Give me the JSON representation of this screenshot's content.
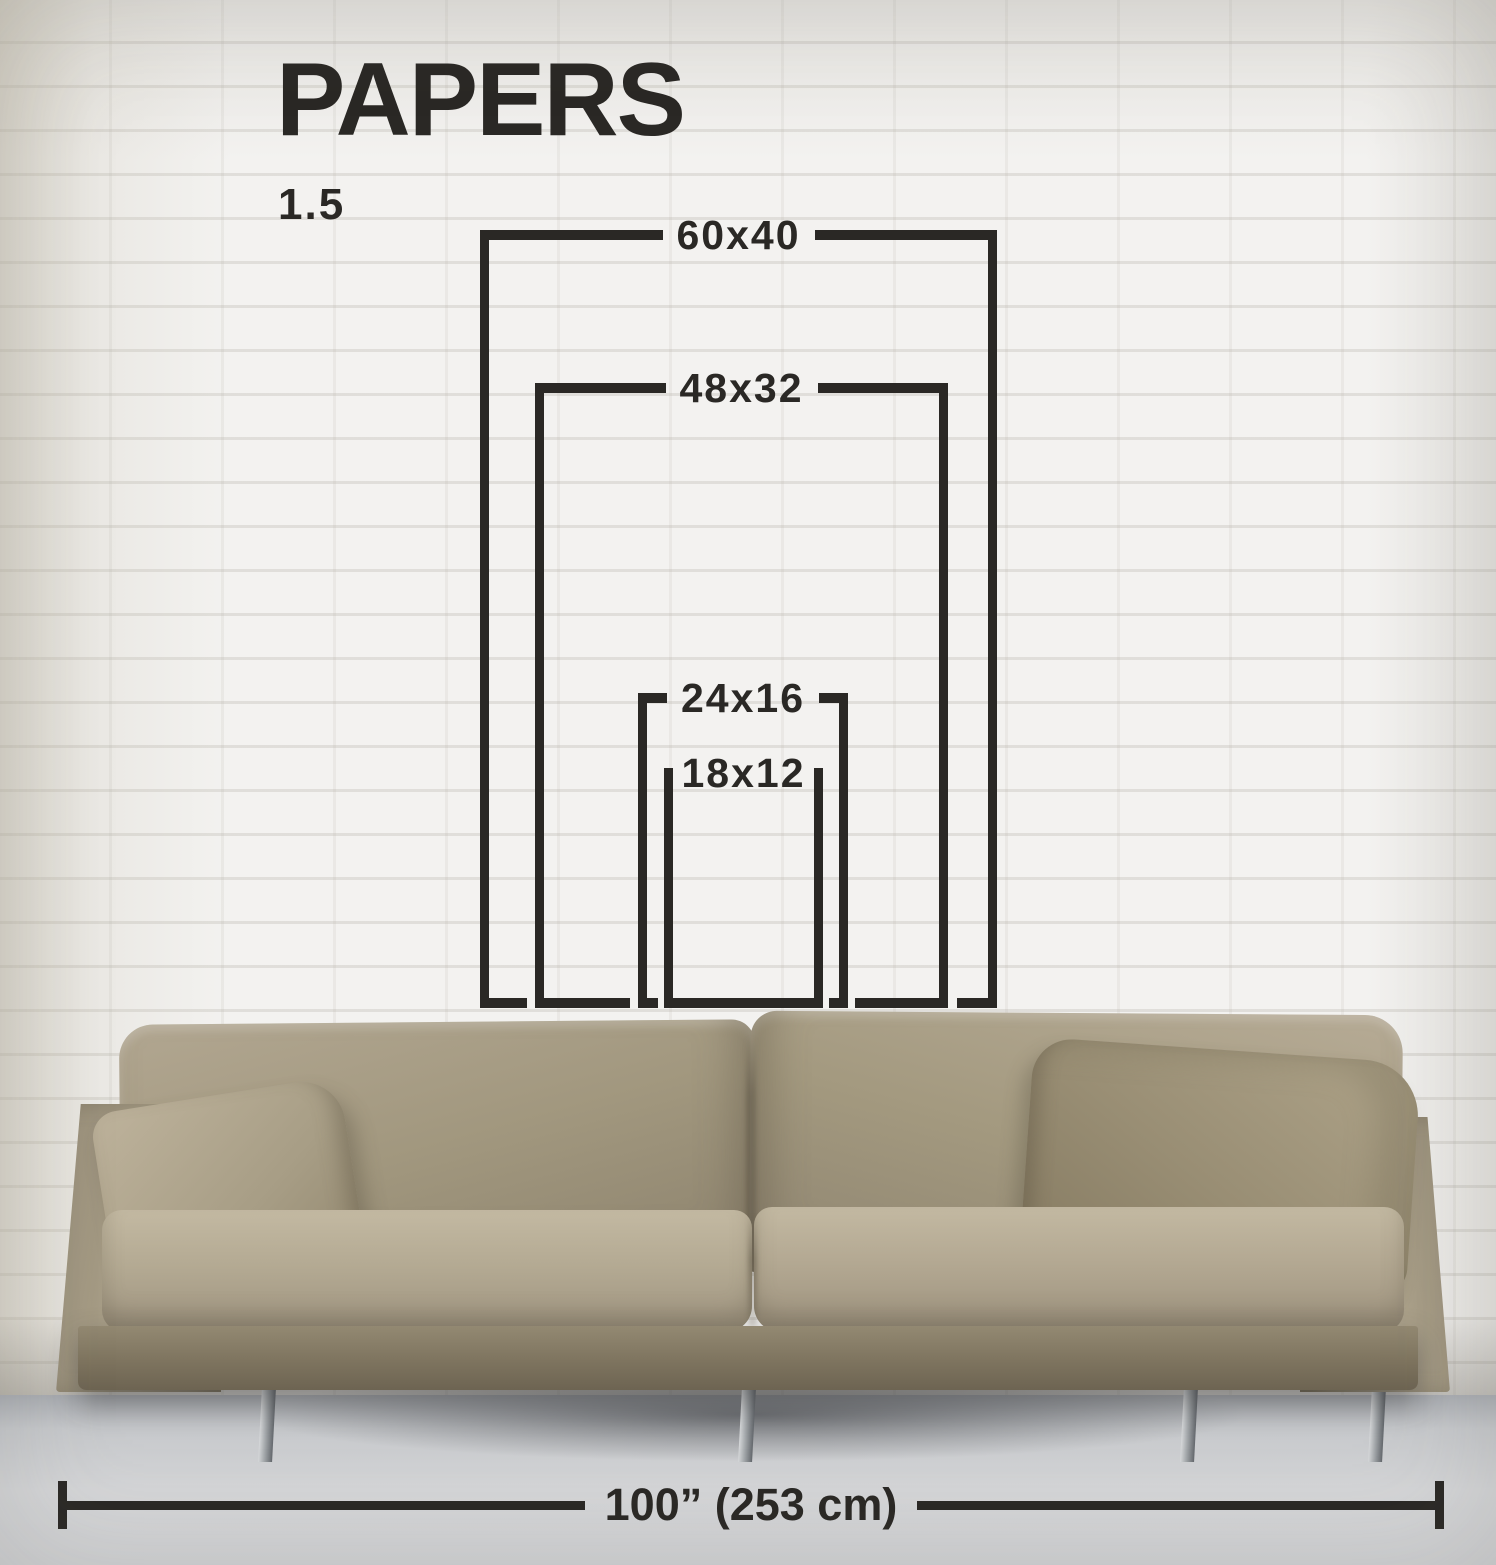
{
  "title": "PAPERS",
  "aspect_ratio_label": "1.5",
  "paper_sizes": [
    {
      "label": "60x40",
      "dimensions_in": [
        60,
        40
      ]
    },
    {
      "label": "48x32",
      "dimensions_in": [
        48,
        32
      ]
    },
    {
      "label": "24x16",
      "dimensions_in": [
        24,
        16
      ]
    },
    {
      "label": "18x12",
      "dimensions_in": [
        18,
        12
      ]
    }
  ],
  "floor_width": {
    "label": "100” (253 cm)",
    "inches": 100,
    "cm": 253
  },
  "colors": {
    "ink": "#2a2825",
    "wall": "#f3f2f0",
    "floor": "#d4d5d7",
    "sofa_fabric": "#a89d85"
  },
  "scene_objects": [
    "white-brick-wall",
    "beige-fabric-sofa",
    "gray-concrete-floor"
  ]
}
